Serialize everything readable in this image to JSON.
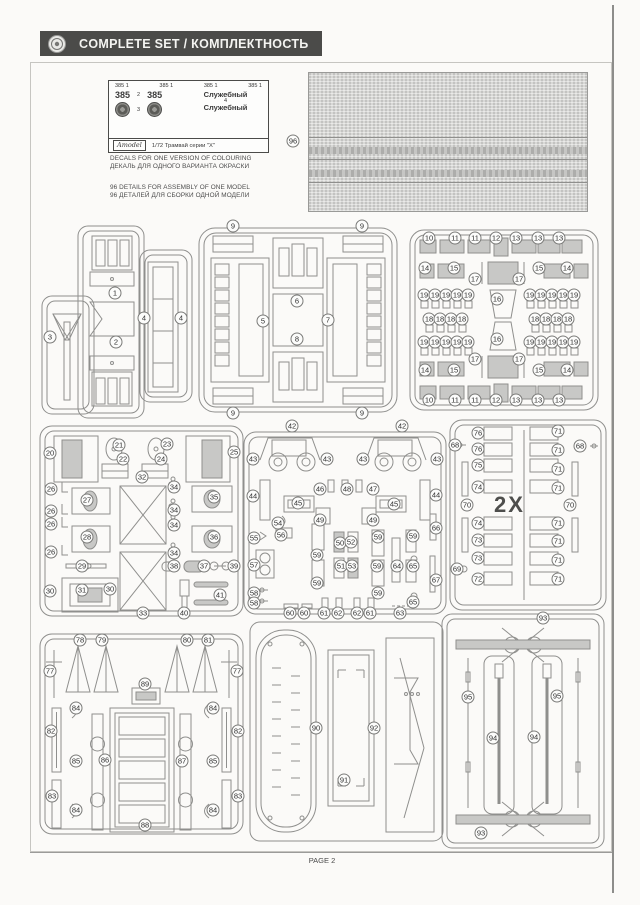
{
  "header": {
    "title": "COMPLETE SET / КОМПЛЕКТНОСТЬ"
  },
  "footer": {
    "page_label": "PAGE 2"
  },
  "notes": {
    "decals_en": "DECALS FOR ONE VERSION OF COLOURING",
    "decals_ru": "ДЕКАЛЬ ДЛЯ ОДНОГО ВАРИАНТА ОКРАСКИ",
    "details_en": "96 DETAILS FOR ASSEMBLY OF ONE MODEL",
    "details_ru": "96 ДЕТАЛЕЙ ДЛЯ СБОРКИ ОДНОЙ МОДЕЛИ"
  },
  "decal_sheet": {
    "top_row": [
      "385 1",
      "385 1",
      "385 1",
      "385 1"
    ],
    "number_left": "385",
    "num2": "2",
    "number_right": "385",
    "num3": "3",
    "num4": "4",
    "word_top": "Служебный",
    "word_bottom": "Служебный",
    "brand": "Amodel",
    "scale_line": "1/72  Трамвай серии \"Х\""
  },
  "multiplier_label": "2X",
  "standalone": {
    "badges": [
      {
        "t": "96",
        "x": 293,
        "y": 141
      }
    ]
  },
  "sprues": [
    {
      "id": "A",
      "badges": [
        {
          "t": "1",
          "x": 75,
          "y": 69
        },
        {
          "t": "2",
          "x": 76,
          "y": 118
        },
        {
          "t": "3",
          "x": 10,
          "y": 113
        },
        {
          "t": "4",
          "x": 104,
          "y": 94
        },
        {
          "t": "4",
          "x": 141,
          "y": 94
        }
      ]
    },
    {
      "id": "B",
      "badges": [
        {
          "t": "9",
          "x": 36,
          "y": 2
        },
        {
          "t": "9",
          "x": 165,
          "y": 2
        },
        {
          "t": "9",
          "x": 36,
          "y": 189
        },
        {
          "t": "9",
          "x": 165,
          "y": 189
        },
        {
          "t": "5",
          "x": 66,
          "y": 97
        },
        {
          "t": "6",
          "x": 100,
          "y": 77
        },
        {
          "t": "7",
          "x": 131,
          "y": 96
        },
        {
          "t": "8",
          "x": 100,
          "y": 115
        }
      ]
    },
    {
      "id": "C",
      "badges": [
        {
          "t": "10",
          "x": 21,
          "y": 10
        },
        {
          "t": "11",
          "x": 47,
          "y": 10
        },
        {
          "t": "11",
          "x": 67,
          "y": 10
        },
        {
          "t": "12",
          "x": 88,
          "y": 10
        },
        {
          "t": "13",
          "x": 108,
          "y": 10
        },
        {
          "t": "13",
          "x": 130,
          "y": 10
        },
        {
          "t": "13",
          "x": 151,
          "y": 10
        },
        {
          "t": "14",
          "x": 17,
          "y": 40
        },
        {
          "t": "15",
          "x": 46,
          "y": 40
        },
        {
          "t": "17",
          "x": 67,
          "y": 51
        },
        {
          "t": "16",
          "x": 89,
          "y": 71
        },
        {
          "t": "17",
          "x": 111,
          "y": 51
        },
        {
          "t": "15",
          "x": 131,
          "y": 40
        },
        {
          "t": "14",
          "x": 159,
          "y": 40
        },
        {
          "t": "19",
          "x": 16,
          "y": 67
        },
        {
          "t": "19",
          "x": 27,
          "y": 67
        },
        {
          "t": "19",
          "x": 38,
          "y": 67
        },
        {
          "t": "19",
          "x": 49,
          "y": 67
        },
        {
          "t": "19",
          "x": 60,
          "y": 67
        },
        {
          "t": "19",
          "x": 122,
          "y": 67
        },
        {
          "t": "19",
          "x": 133,
          "y": 67
        },
        {
          "t": "19",
          "x": 144,
          "y": 67
        },
        {
          "t": "19",
          "x": 155,
          "y": 67
        },
        {
          "t": "19",
          "x": 166,
          "y": 67
        },
        {
          "t": "18",
          "x": 21,
          "y": 91
        },
        {
          "t": "18",
          "x": 32,
          "y": 91
        },
        {
          "t": "18",
          "x": 43,
          "y": 91
        },
        {
          "t": "18",
          "x": 54,
          "y": 91
        },
        {
          "t": "18",
          "x": 127,
          "y": 91
        },
        {
          "t": "18",
          "x": 138,
          "y": 91
        },
        {
          "t": "18",
          "x": 149,
          "y": 91
        },
        {
          "t": "18",
          "x": 160,
          "y": 91
        },
        {
          "t": "19",
          "x": 16,
          "y": 114
        },
        {
          "t": "19",
          "x": 27,
          "y": 114
        },
        {
          "t": "19",
          "x": 38,
          "y": 114
        },
        {
          "t": "19",
          "x": 49,
          "y": 114
        },
        {
          "t": "19",
          "x": 60,
          "y": 114
        },
        {
          "t": "19",
          "x": 122,
          "y": 114
        },
        {
          "t": "19",
          "x": 133,
          "y": 114
        },
        {
          "t": "19",
          "x": 144,
          "y": 114
        },
        {
          "t": "19",
          "x": 155,
          "y": 114
        },
        {
          "t": "19",
          "x": 166,
          "y": 114
        },
        {
          "t": "16",
          "x": 89,
          "y": 111
        },
        {
          "t": "17",
          "x": 67,
          "y": 131
        },
        {
          "t": "17",
          "x": 111,
          "y": 131
        },
        {
          "t": "14",
          "x": 17,
          "y": 142
        },
        {
          "t": "15",
          "x": 46,
          "y": 142
        },
        {
          "t": "15",
          "x": 131,
          "y": 142
        },
        {
          "t": "14",
          "x": 159,
          "y": 142
        },
        {
          "t": "10",
          "x": 21,
          "y": 172
        },
        {
          "t": "11",
          "x": 47,
          "y": 172
        },
        {
          "t": "11",
          "x": 67,
          "y": 172
        },
        {
          "t": "12",
          "x": 88,
          "y": 172
        },
        {
          "t": "13",
          "x": 108,
          "y": 172
        },
        {
          "t": "13",
          "x": 130,
          "y": 172
        },
        {
          "t": "13",
          "x": 151,
          "y": 172
        }
      ]
    },
    {
      "id": "D",
      "badges": [
        {
          "t": "20",
          "x": 12,
          "y": 29
        },
        {
          "t": "21",
          "x": 81,
          "y": 21
        },
        {
          "t": "22",
          "x": 85,
          "y": 35
        },
        {
          "t": "23",
          "x": 129,
          "y": 20
        },
        {
          "t": "24",
          "x": 123,
          "y": 35
        },
        {
          "t": "25",
          "x": 196,
          "y": 28
        },
        {
          "t": "32",
          "x": 104,
          "y": 53
        },
        {
          "t": "26",
          "x": 13,
          "y": 65
        },
        {
          "t": "27",
          "x": 49,
          "y": 76
        },
        {
          "t": "26",
          "x": 13,
          "y": 87
        },
        {
          "t": "26",
          "x": 13,
          "y": 100
        },
        {
          "t": "28",
          "x": 49,
          "y": 113
        },
        {
          "t": "26",
          "x": 13,
          "y": 128
        },
        {
          "t": "29",
          "x": 44,
          "y": 142
        },
        {
          "t": "30",
          "x": 12,
          "y": 167
        },
        {
          "t": "31",
          "x": 44,
          "y": 166
        },
        {
          "t": "30",
          "x": 72,
          "y": 165
        },
        {
          "t": "33",
          "x": 105,
          "y": 189
        },
        {
          "t": "34",
          "x": 136,
          "y": 63
        },
        {
          "t": "34",
          "x": 136,
          "y": 86
        },
        {
          "t": "34",
          "x": 136,
          "y": 101
        },
        {
          "t": "34",
          "x": 136,
          "y": 129
        },
        {
          "t": "35",
          "x": 176,
          "y": 73
        },
        {
          "t": "36",
          "x": 176,
          "y": 113
        },
        {
          "t": "38",
          "x": 136,
          "y": 142
        },
        {
          "t": "37",
          "x": 166,
          "y": 142
        },
        {
          "t": "39",
          "x": 196,
          "y": 142
        },
        {
          "t": "40",
          "x": 146,
          "y": 189
        },
        {
          "t": "41",
          "x": 182,
          "y": 171
        }
      ]
    },
    {
      "id": "E",
      "badges": [
        {
          "t": "42",
          "x": 50,
          "y": 6
        },
        {
          "t": "42",
          "x": 160,
          "y": 6
        },
        {
          "t": "43",
          "x": 11,
          "y": 39
        },
        {
          "t": "43",
          "x": 85,
          "y": 39
        },
        {
          "t": "43",
          "x": 121,
          "y": 39
        },
        {
          "t": "43",
          "x": 195,
          "y": 39
        },
        {
          "t": "44",
          "x": 11,
          "y": 76
        },
        {
          "t": "46",
          "x": 78,
          "y": 69
        },
        {
          "t": "48",
          "x": 105,
          "y": 69
        },
        {
          "t": "47",
          "x": 131,
          "y": 69
        },
        {
          "t": "44",
          "x": 194,
          "y": 75
        },
        {
          "t": "45",
          "x": 56,
          "y": 83
        },
        {
          "t": "45",
          "x": 152,
          "y": 84
        },
        {
          "t": "54",
          "x": 36,
          "y": 103
        },
        {
          "t": "49",
          "x": 78,
          "y": 100
        },
        {
          "t": "49",
          "x": 131,
          "y": 100
        },
        {
          "t": "59",
          "x": 136,
          "y": 117
        },
        {
          "t": "59",
          "x": 171,
          "y": 116
        },
        {
          "t": "66",
          "x": 194,
          "y": 108
        },
        {
          "t": "55",
          "x": 12,
          "y": 118
        },
        {
          "t": "56",
          "x": 39,
          "y": 115
        },
        {
          "t": "50",
          "x": 98,
          "y": 123
        },
        {
          "t": "52",
          "x": 109,
          "y": 122
        },
        {
          "t": "57",
          "x": 12,
          "y": 145
        },
        {
          "t": "51",
          "x": 99,
          "y": 146
        },
        {
          "t": "53",
          "x": 110,
          "y": 146
        },
        {
          "t": "59",
          "x": 135,
          "y": 146
        },
        {
          "t": "64",
          "x": 155,
          "y": 146
        },
        {
          "t": "65",
          "x": 171,
          "y": 146
        },
        {
          "t": "59",
          "x": 75,
          "y": 135
        },
        {
          "t": "59",
          "x": 75,
          "y": 163
        },
        {
          "t": "67",
          "x": 194,
          "y": 160
        },
        {
          "t": "58",
          "x": 12,
          "y": 173
        },
        {
          "t": "58",
          "x": 12,
          "y": 183
        },
        {
          "t": "59",
          "x": 136,
          "y": 173
        },
        {
          "t": "65",
          "x": 171,
          "y": 182
        },
        {
          "t": "60",
          "x": 48,
          "y": 193
        },
        {
          "t": "60",
          "x": 62,
          "y": 193
        },
        {
          "t": "61",
          "x": 82,
          "y": 193
        },
        {
          "t": "62",
          "x": 96,
          "y": 193
        },
        {
          "t": "62",
          "x": 115,
          "y": 193
        },
        {
          "t": "61",
          "x": 128,
          "y": 193
        },
        {
          "t": "63",
          "x": 158,
          "y": 193
        }
      ]
    },
    {
      "id": "F",
      "badges": [
        {
          "t": "68",
          "x": 7,
          "y": 27
        },
        {
          "t": "68",
          "x": 132,
          "y": 28
        },
        {
          "t": "69",
          "x": 9,
          "y": 151
        },
        {
          "t": "70",
          "x": 19,
          "y": 87
        },
        {
          "t": "70",
          "x": 122,
          "y": 87
        },
        {
          "t": "76",
          "x": 30,
          "y": 15
        },
        {
          "t": "76",
          "x": 30,
          "y": 31
        },
        {
          "t": "75",
          "x": 30,
          "y": 47
        },
        {
          "t": "74",
          "x": 30,
          "y": 69
        },
        {
          "t": "74",
          "x": 30,
          "y": 105
        },
        {
          "t": "73",
          "x": 30,
          "y": 122
        },
        {
          "t": "73",
          "x": 30,
          "y": 140
        },
        {
          "t": "72",
          "x": 30,
          "y": 161
        },
        {
          "t": "71",
          "x": 110,
          "y": 13
        },
        {
          "t": "71",
          "x": 110,
          "y": 32
        },
        {
          "t": "71",
          "x": 110,
          "y": 51
        },
        {
          "t": "71",
          "x": 110,
          "y": 70
        },
        {
          "t": "71",
          "x": 110,
          "y": 105
        },
        {
          "t": "71",
          "x": 110,
          "y": 123
        },
        {
          "t": "71",
          "x": 110,
          "y": 142
        },
        {
          "t": "71",
          "x": 110,
          "y": 161
        }
      ]
    },
    {
      "id": "G",
      "badges": [
        {
          "t": "78",
          "x": 42,
          "y": 10
        },
        {
          "t": "79",
          "x": 64,
          "y": 10
        },
        {
          "t": "80",
          "x": 149,
          "y": 10
        },
        {
          "t": "81",
          "x": 170,
          "y": 10
        },
        {
          "t": "77",
          "x": 12,
          "y": 41
        },
        {
          "t": "77",
          "x": 199,
          "y": 41
        },
        {
          "t": "89",
          "x": 107,
          "y": 54
        },
        {
          "t": "84",
          "x": 38,
          "y": 78
        },
        {
          "t": "84",
          "x": 175,
          "y": 78
        },
        {
          "t": "84",
          "x": 38,
          "y": 180
        },
        {
          "t": "84",
          "x": 175,
          "y": 180
        },
        {
          "t": "82",
          "x": 13,
          "y": 101
        },
        {
          "t": "82",
          "x": 200,
          "y": 101
        },
        {
          "t": "85",
          "x": 38,
          "y": 131
        },
        {
          "t": "85",
          "x": 175,
          "y": 131
        },
        {
          "t": "86",
          "x": 67,
          "y": 130
        },
        {
          "t": "87",
          "x": 144,
          "y": 131
        },
        {
          "t": "83",
          "x": 14,
          "y": 166
        },
        {
          "t": "83",
          "x": 200,
          "y": 166
        },
        {
          "t": "88",
          "x": 107,
          "y": 195
        }
      ]
    },
    {
      "id": "H",
      "badges": [
        {
          "t": "90",
          "x": 68,
          "y": 110
        },
        {
          "t": "91",
          "x": 96,
          "y": 162
        },
        {
          "t": "92",
          "x": 126,
          "y": 110
        }
      ]
    },
    {
      "id": "I",
      "badges": [
        {
          "t": "93",
          "x": 103,
          "y": 6
        },
        {
          "t": "93",
          "x": 41,
          "y": 221
        },
        {
          "t": "95",
          "x": 28,
          "y": 85
        },
        {
          "t": "95",
          "x": 117,
          "y": 84
        },
        {
          "t": "94",
          "x": 53,
          "y": 126
        },
        {
          "t": "94",
          "x": 94,
          "y": 125
        }
      ]
    }
  ]
}
